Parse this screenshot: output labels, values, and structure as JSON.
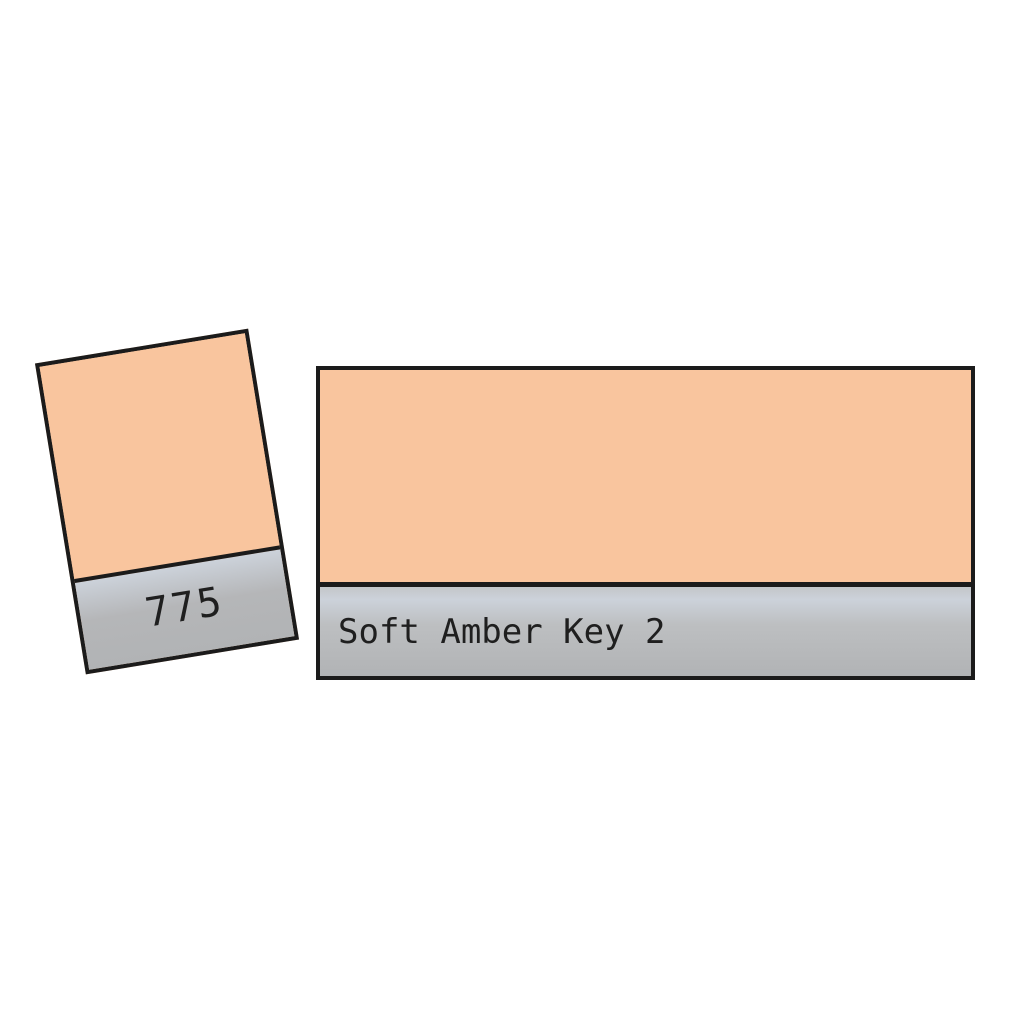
{
  "filter": {
    "code": "775",
    "name": "Soft Amber Key 2"
  },
  "colors": {
    "swatch": "#F9C59E",
    "band-gray": "#B5B6B8",
    "band-gray-light": "#CCD2DA",
    "band-gray-dark": "#B1B3B5",
    "border": "#1B1B1B",
    "text": "#1F1F1F",
    "background": "#FFFFFF"
  }
}
